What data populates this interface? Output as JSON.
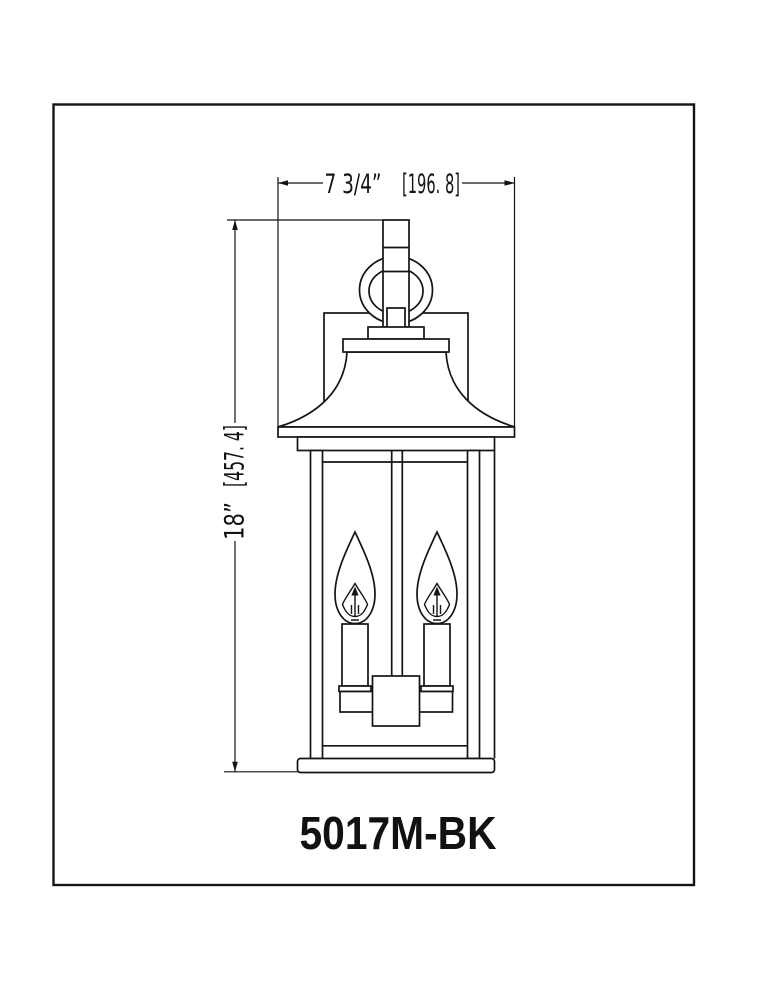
{
  "page": {
    "background": "#ffffff",
    "line_color": "#141414"
  },
  "dimensions": {
    "width": {
      "imperial": "7 3/4”",
      "metric_mm": "[196. 8]"
    },
    "height": {
      "imperial": "18”",
      "metric_mm": "[457. 4]"
    }
  },
  "label": {
    "model_number": "5017M-BK"
  }
}
